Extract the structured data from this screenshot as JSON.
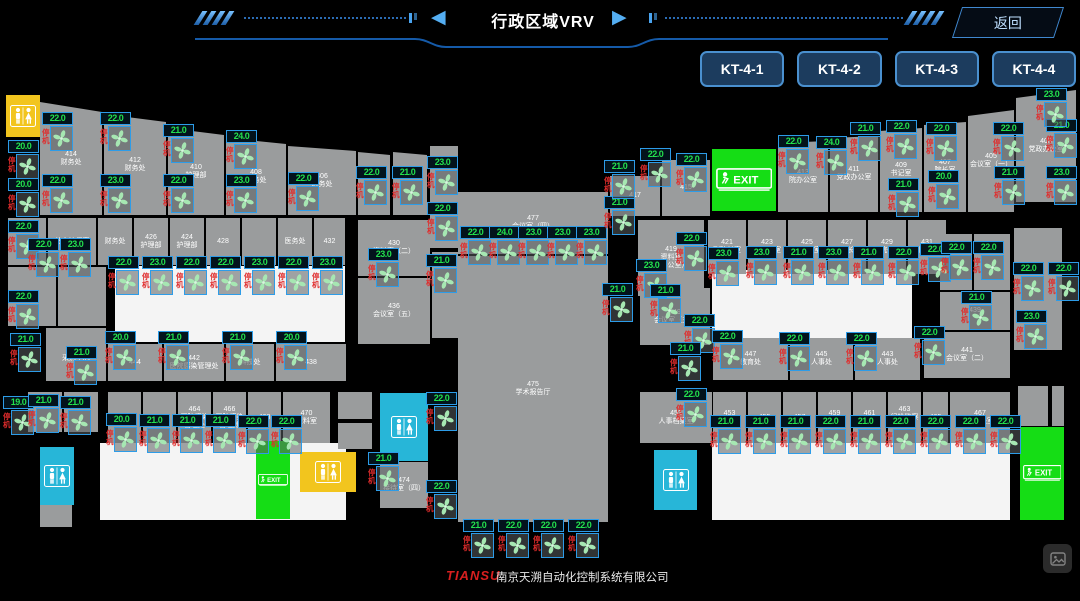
{
  "header": {
    "title": "行政区域VRV",
    "back_label": "返回"
  },
  "unit_buttons": [
    "KT-4-1",
    "KT-4-2",
    "KT-4-3",
    "KT-4-4"
  ],
  "labels": {
    "exit": "EXIT"
  },
  "fan_defaults": {
    "status_label": "停机"
  },
  "footer": {
    "brand": "TIANSU",
    "company": "南京天溯自动化控制系统有限公司"
  },
  "colors": {
    "accent_blue": "#4a90cf",
    "temp_green": "#23e04d",
    "status_red": "#e02c2c",
    "exit_green": "#15dd15",
    "restroom_cyan": "#27b6d8",
    "restroom_yellow": "#f2c51e",
    "room_gray": "#9a9c9d"
  },
  "floorplan": {
    "white_areas": [
      {
        "x": 115,
        "y": 266,
        "w": 230,
        "h": 76
      },
      {
        "x": 712,
        "y": 270,
        "w": 200,
        "h": 72
      },
      {
        "x": 100,
        "y": 443,
        "w": 246,
        "h": 77
      },
      {
        "x": 712,
        "y": 443,
        "w": 298,
        "h": 77
      }
    ],
    "rooms": [
      {
        "x": 40,
        "y": 102,
        "w": 62,
        "h": 113,
        "label": "414\n财务处",
        "sa": 0,
        "sb": 10
      },
      {
        "x": 104,
        "y": 114,
        "w": 62,
        "h": 101,
        "label": "412\n财务处",
        "sa": 0,
        "sb": 8
      },
      {
        "x": 168,
        "y": 128,
        "w": 56,
        "h": 87,
        "label": "410\n护理部",
        "sa": 0,
        "sb": 7
      },
      {
        "x": 226,
        "y": 138,
        "w": 60,
        "h": 77,
        "label": "408\n总务处",
        "sa": 0,
        "sb": 6
      },
      {
        "x": 288,
        "y": 146,
        "w": 68,
        "h": 69,
        "label": "406\n医务处",
        "sa": 0,
        "sb": 5
      },
      {
        "x": 358,
        "y": 152,
        "w": 32,
        "h": 63,
        "label": "",
        "sa": 0,
        "sb": 3
      },
      {
        "x": 393,
        "y": 152,
        "w": 34,
        "h": 63,
        "label": "",
        "sa": 0,
        "sb": 3
      },
      {
        "x": 430,
        "y": 146,
        "w": 28,
        "h": 102,
        "label": ""
      },
      {
        "x": 432,
        "y": 252,
        "w": 26,
        "h": 86,
        "label": ""
      },
      {
        "x": 610,
        "y": 176,
        "w": 50,
        "h": 40,
        "label": "417"
      },
      {
        "x": 662,
        "y": 160,
        "w": 48,
        "h": 56,
        "label": "415"
      },
      {
        "x": 778,
        "y": 141,
        "w": 50,
        "h": 71,
        "label": "413\n院办公室",
        "sa": 2,
        "sb": 0
      },
      {
        "x": 830,
        "y": 136,
        "w": 48,
        "h": 76,
        "label": "411\n党政办公室",
        "sa": 2,
        "sb": 0
      },
      {
        "x": 880,
        "y": 128,
        "w": 42,
        "h": 84,
        "label": "409\n书记室",
        "sa": 3,
        "sb": 0
      },
      {
        "x": 924,
        "y": 122,
        "w": 42,
        "h": 90,
        "label": "407\n院长室",
        "sa": 3,
        "sb": 0
      },
      {
        "x": 968,
        "y": 110,
        "w": 46,
        "h": 102,
        "label": "405\n会议室（一）",
        "sa": 6,
        "sb": 0
      },
      {
        "x": 1016,
        "y": 90,
        "w": 60,
        "h": 112,
        "label": "403\n党政办公室",
        "sa": 8,
        "sb": 0
      },
      {
        "x": 638,
        "y": 220,
        "w": 66,
        "h": 76,
        "label": "419\n资料室\n（办公室）"
      },
      {
        "x": 708,
        "y": 220,
        "w": 38,
        "h": 54,
        "label": "421\n副院长室"
      },
      {
        "x": 748,
        "y": 220,
        "w": 38,
        "h": 54,
        "label": "423\n副院长室"
      },
      {
        "x": 788,
        "y": 220,
        "w": 38,
        "h": 54,
        "label": "425\n副院长室"
      },
      {
        "x": 828,
        "y": 220,
        "w": 38,
        "h": 54,
        "label": "427\n副院长室"
      },
      {
        "x": 868,
        "y": 220,
        "w": 38,
        "h": 54,
        "label": "429\n副院长室"
      },
      {
        "x": 908,
        "y": 220,
        "w": 38,
        "h": 54,
        "label": "431\n副院长室"
      },
      {
        "x": 940,
        "y": 234,
        "w": 32,
        "h": 56,
        "label": ""
      },
      {
        "x": 974,
        "y": 234,
        "w": 36,
        "h": 56,
        "label": ""
      },
      {
        "x": 940,
        "y": 292,
        "w": 70,
        "h": 38,
        "label": "439"
      },
      {
        "x": 924,
        "y": 332,
        "w": 86,
        "h": 46,
        "label": "441\n会议室（二）"
      },
      {
        "x": 640,
        "y": 288,
        "w": 70,
        "h": 57,
        "label": "449\n会议室（三）"
      },
      {
        "x": 1014,
        "y": 228,
        "w": 48,
        "h": 122,
        "label": ""
      },
      {
        "x": 8,
        "y": 218,
        "w": 38,
        "h": 47,
        "label": ""
      },
      {
        "x": 48,
        "y": 218,
        "w": 48,
        "h": 47,
        "label": "总会计师室"
      },
      {
        "x": 98,
        "y": 218,
        "w": 34,
        "h": 47,
        "label": "财务处"
      },
      {
        "x": 134,
        "y": 218,
        "w": 34,
        "h": 47,
        "label": "426\n护理部"
      },
      {
        "x": 170,
        "y": 218,
        "w": 34,
        "h": 47,
        "label": "424\n护理部"
      },
      {
        "x": 206,
        "y": 218,
        "w": 34,
        "h": 47,
        "label": "428"
      },
      {
        "x": 242,
        "y": 218,
        "w": 34,
        "h": 47,
        "label": ""
      },
      {
        "x": 278,
        "y": 218,
        "w": 34,
        "h": 47,
        "label": "医务处"
      },
      {
        "x": 314,
        "y": 218,
        "w": 31,
        "h": 47,
        "label": "432"
      },
      {
        "x": 358,
        "y": 220,
        "w": 72,
        "h": 56,
        "label": "430\n资料室（二）"
      },
      {
        "x": 358,
        "y": 278,
        "w": 72,
        "h": 66,
        "label": "436\n会议室（五）"
      },
      {
        "x": 8,
        "y": 267,
        "w": 48,
        "h": 59,
        "label": ""
      },
      {
        "x": 58,
        "y": 267,
        "w": 48,
        "h": 59,
        "label": ""
      },
      {
        "x": 46,
        "y": 328,
        "w": 60,
        "h": 53,
        "label": "446\n采购中心"
      },
      {
        "x": 108,
        "y": 344,
        "w": 54,
        "h": 37,
        "label": "444"
      },
      {
        "x": 164,
        "y": 344,
        "w": 60,
        "h": 37,
        "label": "442\n医院感染管理处"
      },
      {
        "x": 226,
        "y": 344,
        "w": 48,
        "h": 37,
        "label": "科技处"
      },
      {
        "x": 276,
        "y": 344,
        "w": 70,
        "h": 37,
        "label": "438"
      },
      {
        "x": 28,
        "y": 392,
        "w": 34,
        "h": 40,
        "label": ""
      },
      {
        "x": 64,
        "y": 392,
        "w": 34,
        "h": 40,
        "label": ""
      },
      {
        "x": 108,
        "y": 392,
        "w": 33,
        "h": 51,
        "label": "460"
      },
      {
        "x": 143,
        "y": 392,
        "w": 33,
        "h": 51,
        "label": "462"
      },
      {
        "x": 178,
        "y": 392,
        "w": 33,
        "h": 51,
        "label": "464\n医院感染\n管理处"
      },
      {
        "x": 213,
        "y": 392,
        "w": 33,
        "h": 51,
        "label": "466\n医院感染\n管理处"
      },
      {
        "x": 248,
        "y": 392,
        "w": 33,
        "h": 51,
        "label": "468"
      },
      {
        "x": 283,
        "y": 392,
        "w": 47,
        "h": 51,
        "label": "470\n资料室"
      },
      {
        "x": 338,
        "y": 392,
        "w": 34,
        "h": 27,
        "label": ""
      },
      {
        "x": 338,
        "y": 423,
        "w": 34,
        "h": 26,
        "label": ""
      },
      {
        "x": 380,
        "y": 462,
        "w": 48,
        "h": 46,
        "label": "474\n接待室（四）"
      },
      {
        "x": 458,
        "y": 192,
        "w": 150,
        "h": 62,
        "label": "477\n会议室（四）"
      },
      {
        "x": 458,
        "y": 256,
        "w": 150,
        "h": 266,
        "label": "475\n学术报告厅"
      },
      {
        "x": 713,
        "y": 338,
        "w": 75,
        "h": 42,
        "label": "447\n教育处"
      },
      {
        "x": 790,
        "y": 338,
        "w": 63,
        "h": 42,
        "label": "445\n人事处"
      },
      {
        "x": 855,
        "y": 338,
        "w": 65,
        "h": 42,
        "label": "443\n人事处"
      },
      {
        "x": 640,
        "y": 392,
        "w": 72,
        "h": 51,
        "label": "451\n人事档案室"
      },
      {
        "x": 713,
        "y": 392,
        "w": 33,
        "h": 51,
        "label": "453\n教育处"
      },
      {
        "x": 748,
        "y": 392,
        "w": 33,
        "h": 51,
        "label": "455"
      },
      {
        "x": 783,
        "y": 392,
        "w": 33,
        "h": 51,
        "label": "457"
      },
      {
        "x": 818,
        "y": 392,
        "w": 33,
        "h": 51,
        "label": "459\n工会"
      },
      {
        "x": 853,
        "y": 392,
        "w": 33,
        "h": 51,
        "label": "461\n人事处"
      },
      {
        "x": 888,
        "y": 392,
        "w": 33,
        "h": 51,
        "label": "463\n纪检监察室"
      },
      {
        "x": 923,
        "y": 392,
        "w": 25,
        "h": 51,
        "label": "465"
      },
      {
        "x": 950,
        "y": 392,
        "w": 60,
        "h": 51,
        "label": "467\n副院长室"
      },
      {
        "x": 1018,
        "y": 386,
        "w": 30,
        "h": 40,
        "label": ""
      },
      {
        "x": 1052,
        "y": 386,
        "w": 12,
        "h": 40,
        "label": ""
      },
      {
        "x": 40,
        "y": 505,
        "w": 32,
        "h": 22,
        "label": ""
      }
    ],
    "specials": [
      {
        "type": "restroom-yellow",
        "x": 6,
        "y": 95,
        "w": 34,
        "h": 42
      },
      {
        "type": "restroom-cyan",
        "x": 40,
        "y": 447,
        "w": 34,
        "h": 58
      },
      {
        "type": "restroom-yellow",
        "x": 300,
        "y": 452,
        "w": 56,
        "h": 40
      },
      {
        "type": "exit",
        "x": 256,
        "y": 441,
        "w": 34,
        "h": 78
      },
      {
        "type": "restroom-cyan",
        "x": 380,
        "y": 393,
        "w": 48,
        "h": 68
      },
      {
        "type": "restroom-cyan",
        "x": 654,
        "y": 450,
        "w": 43,
        "h": 60
      },
      {
        "type": "exit",
        "x": 1020,
        "y": 427,
        "w": 44,
        "h": 93
      },
      {
        "type": "exit",
        "x": 712,
        "y": 149,
        "w": 64,
        "h": 62
      }
    ],
    "fans": [
      {
        "x": 8,
        "y": 140,
        "t": "20.0"
      },
      {
        "x": 8,
        "y": 178,
        "t": "20.0"
      },
      {
        "x": 8,
        "y": 220,
        "t": "22.0"
      },
      {
        "x": 8,
        "y": 290,
        "t": "22.0"
      },
      {
        "x": 10,
        "y": 333,
        "t": "21.0"
      },
      {
        "x": 3,
        "y": 396,
        "t": "19.0"
      },
      {
        "x": 42,
        "y": 112,
        "t": "22.0"
      },
      {
        "x": 42,
        "y": 174,
        "t": "22.0"
      },
      {
        "x": 100,
        "y": 112,
        "t": "22.0"
      },
      {
        "x": 100,
        "y": 174,
        "t": "23.0"
      },
      {
        "x": 163,
        "y": 124,
        "t": "21.0"
      },
      {
        "x": 163,
        "y": 174,
        "t": "22.0"
      },
      {
        "x": 226,
        "y": 130,
        "t": "24.0"
      },
      {
        "x": 226,
        "y": 174,
        "t": "23.0"
      },
      {
        "x": 288,
        "y": 172,
        "t": "22.0"
      },
      {
        "x": 356,
        "y": 166,
        "t": "22.0"
      },
      {
        "x": 392,
        "y": 166,
        "t": "21.0"
      },
      {
        "x": 427,
        "y": 156,
        "t": "23.0"
      },
      {
        "x": 427,
        "y": 202,
        "t": "22.0"
      },
      {
        "x": 426,
        "y": 254,
        "t": "21.0"
      },
      {
        "x": 28,
        "y": 238,
        "t": "22.0"
      },
      {
        "x": 60,
        "y": 238,
        "t": "23.0"
      },
      {
        "x": 108,
        "y": 256,
        "t": "22.0"
      },
      {
        "x": 142,
        "y": 256,
        "t": "23.0"
      },
      {
        "x": 176,
        "y": 256,
        "t": "22.0"
      },
      {
        "x": 210,
        "y": 256,
        "t": "22.0"
      },
      {
        "x": 244,
        "y": 256,
        "t": "23.0"
      },
      {
        "x": 278,
        "y": 256,
        "t": "22.0"
      },
      {
        "x": 312,
        "y": 256,
        "t": "23.0"
      },
      {
        "x": 368,
        "y": 248,
        "t": "23.0"
      },
      {
        "x": 460,
        "y": 226,
        "t": "22.0"
      },
      {
        "x": 489,
        "y": 226,
        "t": "24.0"
      },
      {
        "x": 518,
        "y": 226,
        "t": "23.0"
      },
      {
        "x": 547,
        "y": 226,
        "t": "23.0"
      },
      {
        "x": 576,
        "y": 226,
        "t": "23.0"
      },
      {
        "x": 604,
        "y": 196,
        "t": "21.0"
      },
      {
        "x": 602,
        "y": 283,
        "t": "21.0"
      },
      {
        "x": 604,
        "y": 160,
        "t": "21.0"
      },
      {
        "x": 640,
        "y": 148,
        "t": "22.0"
      },
      {
        "x": 676,
        "y": 153,
        "t": "22.0"
      },
      {
        "x": 778,
        "y": 135,
        "t": "22.0"
      },
      {
        "x": 816,
        "y": 136,
        "t": "24.0"
      },
      {
        "x": 850,
        "y": 122,
        "t": "21.0"
      },
      {
        "x": 886,
        "y": 120,
        "t": "22.0"
      },
      {
        "x": 888,
        "y": 178,
        "t": "21.0"
      },
      {
        "x": 926,
        "y": 122,
        "t": "22.0"
      },
      {
        "x": 928,
        "y": 170,
        "t": "20.0"
      },
      {
        "x": 993,
        "y": 122,
        "t": "22.0"
      },
      {
        "x": 1046,
        "y": 119,
        "t": "21.0"
      },
      {
        "x": 994,
        "y": 166,
        "t": "21.0"
      },
      {
        "x": 1046,
        "y": 166,
        "t": "23.0"
      },
      {
        "x": 1036,
        "y": 88,
        "t": "23.0"
      },
      {
        "x": 676,
        "y": 232,
        "t": "22.0"
      },
      {
        "x": 636,
        "y": 259,
        "t": "23.0"
      },
      {
        "x": 708,
        "y": 247,
        "t": "23.0"
      },
      {
        "x": 746,
        "y": 246,
        "t": "23.0"
      },
      {
        "x": 783,
        "y": 246,
        "t": "21.0"
      },
      {
        "x": 818,
        "y": 246,
        "t": "23.0"
      },
      {
        "x": 853,
        "y": 246,
        "t": "21.0"
      },
      {
        "x": 888,
        "y": 246,
        "t": "22.0"
      },
      {
        "x": 920,
        "y": 243,
        "t": "22.0"
      },
      {
        "x": 650,
        "y": 284,
        "t": "21.0"
      },
      {
        "x": 684,
        "y": 314,
        "t": "22.0"
      },
      {
        "x": 670,
        "y": 342,
        "t": "21.0"
      },
      {
        "x": 941,
        "y": 241,
        "t": "22.0"
      },
      {
        "x": 973,
        "y": 241,
        "t": "22.0"
      },
      {
        "x": 1013,
        "y": 262,
        "t": "22.0"
      },
      {
        "x": 1048,
        "y": 262,
        "t": "22.0"
      },
      {
        "x": 961,
        "y": 291,
        "t": "21.0"
      },
      {
        "x": 1016,
        "y": 310,
        "t": "23.0"
      },
      {
        "x": 66,
        "y": 346,
        "t": "21.0"
      },
      {
        "x": 105,
        "y": 331,
        "t": "20.0"
      },
      {
        "x": 158,
        "y": 331,
        "t": "21.0"
      },
      {
        "x": 222,
        "y": 331,
        "t": "21.0"
      },
      {
        "x": 276,
        "y": 331,
        "t": "20.0"
      },
      {
        "x": 28,
        "y": 394,
        "t": "21.0"
      },
      {
        "x": 60,
        "y": 396,
        "t": "21.0"
      },
      {
        "x": 106,
        "y": 413,
        "t": "20.0"
      },
      {
        "x": 139,
        "y": 414,
        "t": "21.0"
      },
      {
        "x": 172,
        "y": 414,
        "t": "21.0"
      },
      {
        "x": 205,
        "y": 414,
        "t": "21.0"
      },
      {
        "x": 238,
        "y": 415,
        "t": "22.0"
      },
      {
        "x": 271,
        "y": 415,
        "t": "22.0"
      },
      {
        "x": 426,
        "y": 392,
        "t": "22.0"
      },
      {
        "x": 368,
        "y": 452,
        "t": "21.0"
      },
      {
        "x": 426,
        "y": 480,
        "t": "22.0"
      },
      {
        "x": 463,
        "y": 519,
        "t": "21.0"
      },
      {
        "x": 498,
        "y": 519,
        "t": "22.0"
      },
      {
        "x": 533,
        "y": 519,
        "t": "22.0"
      },
      {
        "x": 568,
        "y": 519,
        "t": "22.0"
      },
      {
        "x": 712,
        "y": 330,
        "t": "22.0"
      },
      {
        "x": 779,
        "y": 332,
        "t": "22.0"
      },
      {
        "x": 846,
        "y": 332,
        "t": "22.0"
      },
      {
        "x": 914,
        "y": 326,
        "t": "22.0"
      },
      {
        "x": 676,
        "y": 388,
        "t": "22.0"
      },
      {
        "x": 710,
        "y": 415,
        "t": "21.0"
      },
      {
        "x": 745,
        "y": 415,
        "t": "21.0"
      },
      {
        "x": 780,
        "y": 415,
        "t": "21.0"
      },
      {
        "x": 815,
        "y": 415,
        "t": "22.0"
      },
      {
        "x": 850,
        "y": 415,
        "t": "21.0"
      },
      {
        "x": 885,
        "y": 415,
        "t": "22.0"
      },
      {
        "x": 920,
        "y": 415,
        "t": "22.0"
      },
      {
        "x": 955,
        "y": 415,
        "t": "22.0"
      },
      {
        "x": 990,
        "y": 415,
        "t": "22.0"
      }
    ]
  }
}
